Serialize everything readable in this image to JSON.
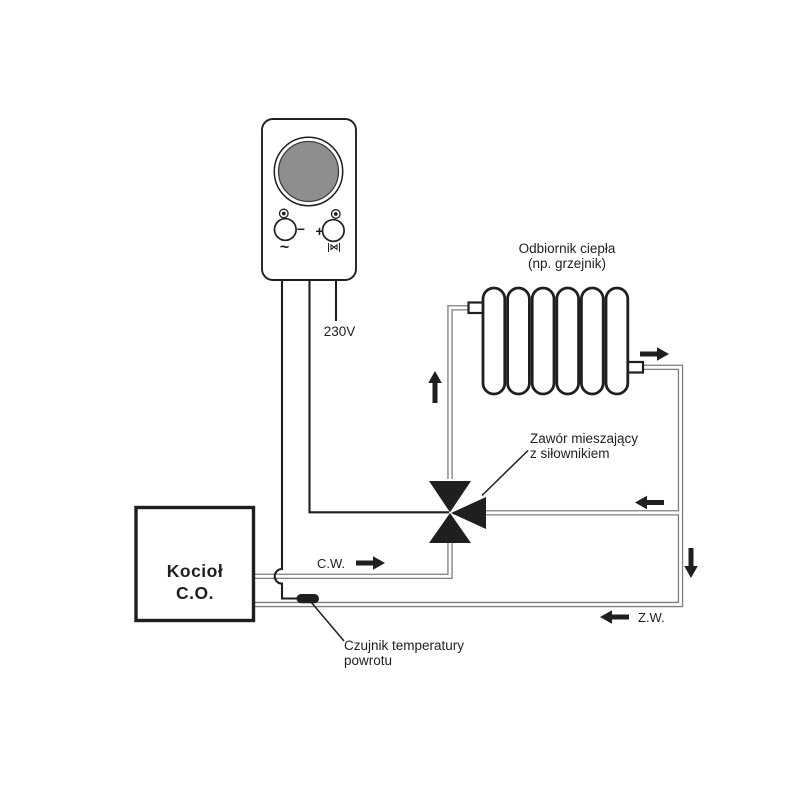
{
  "title": "Schemat instalacji c.o. z zaworem mieszającym",
  "colors": {
    "line": "#1f1f1f",
    "pipe": "#7d7d7d",
    "dial_gray": "#8e8e8e",
    "background": "#ffffff"
  },
  "controller": {
    "power_label": "230V",
    "minus_symbol": "−",
    "plus_symbol": "+",
    "sine_symbol": "~",
    "valve_mode_symbol": "⋈"
  },
  "boiler": {
    "name_line1": "Kocioł",
    "name_line2": "C.O."
  },
  "radiator": {
    "caption_line1": "Odbiornik ciepła",
    "caption_line2": "(np. grzejnik)"
  },
  "mixing_valve": {
    "caption_line1": "Zawór mieszający",
    "caption_line2": "z siłownikiem"
  },
  "return_sensor": {
    "caption_line1": "Czujnik temperatury",
    "caption_line2": "powrotu"
  },
  "flow_labels": {
    "supply": "C.W.",
    "return": "Z.W."
  }
}
